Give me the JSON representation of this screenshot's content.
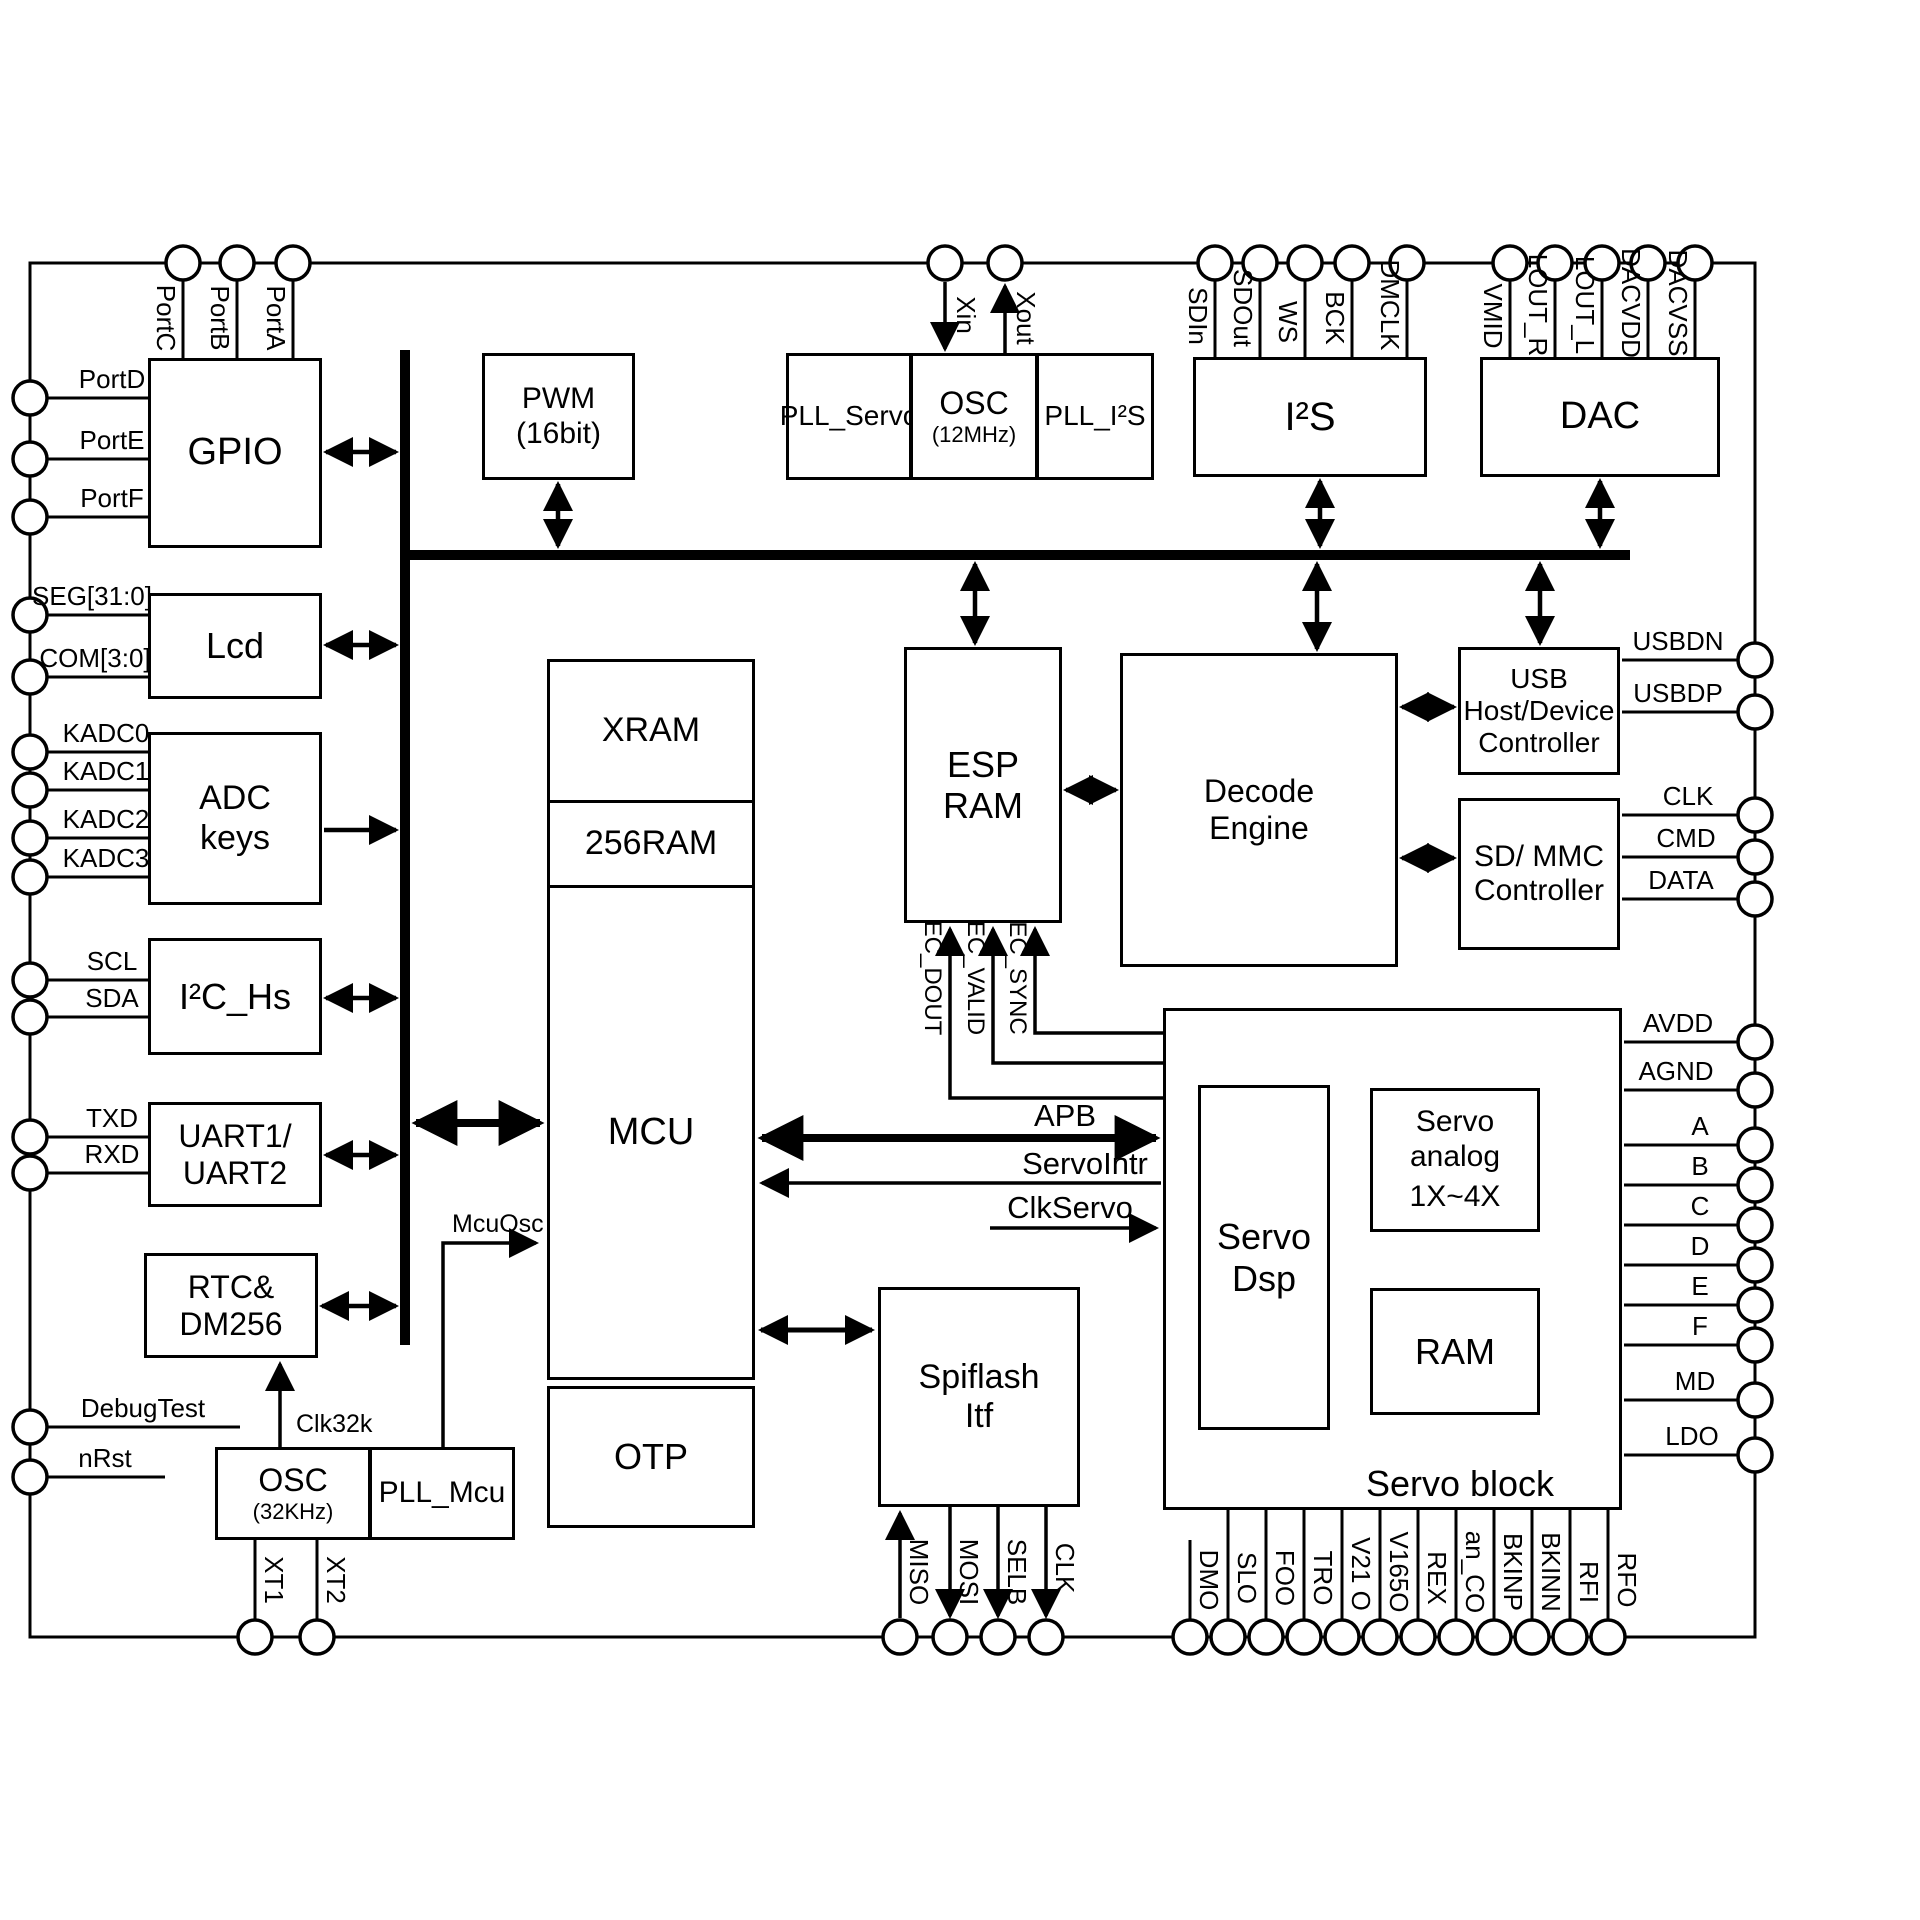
{
  "blocks": {
    "gpio": {
      "lines": [
        "GPIO"
      ]
    },
    "lcd": {
      "lines": [
        "Lcd"
      ]
    },
    "adc": {
      "lines": [
        "ADC",
        "keys"
      ]
    },
    "i2c": {
      "lines": [
        "I²C_Hs"
      ]
    },
    "uart": {
      "lines": [
        "UART1/",
        "UART2"
      ]
    },
    "rtc": {
      "lines": [
        "RTC&",
        "DM256"
      ]
    },
    "osc32": {
      "lines": [
        "OSC",
        "(32KHz)"
      ]
    },
    "pll_mcu": {
      "lines": [
        "PLL_Mcu"
      ]
    },
    "pwm": {
      "lines": [
        "PWM",
        "(16bit)"
      ]
    },
    "pll_servo": {
      "lines": [
        "PLL_Servo"
      ]
    },
    "osc12": {
      "lines": [
        "OSC",
        "(12MHz)"
      ]
    },
    "pll_i2s": {
      "lines": [
        "PLL_I²S"
      ]
    },
    "i2s": {
      "lines": [
        "I²S"
      ]
    },
    "dac": {
      "lines": [
        "DAC"
      ]
    },
    "xram": {
      "lines": [
        "XRAM"
      ]
    },
    "ram256": {
      "lines": [
        "256RAM"
      ]
    },
    "mcu": {
      "lines": [
        "MCU"
      ]
    },
    "otp": {
      "lines": [
        "OTP"
      ]
    },
    "esp_ram": {
      "lines": [
        "ESP RAM"
      ]
    },
    "decode": {
      "lines": [
        "Decode",
        "Engine"
      ]
    },
    "usb": {
      "lines": [
        "USB",
        "Host/Device",
        "Controller"
      ]
    },
    "sdmmc": {
      "lines": [
        "SD/ MMC",
        "Controller"
      ]
    },
    "spiflash": {
      "lines": [
        "Spiflash",
        "Itf"
      ]
    },
    "servo_dsp": {
      "lines": [
        "Servo Dsp"
      ]
    },
    "servo_analog": {
      "lines": [
        "Servo",
        "analog",
        "1X~4X"
      ]
    },
    "servo_ram": {
      "lines": [
        "RAM"
      ]
    },
    "servo_block": {
      "label": "Servo block"
    }
  },
  "pins": {
    "top": [
      {
        "label": "PortC"
      },
      {
        "label": "PortB"
      },
      {
        "label": "PortA"
      },
      {
        "label": "Xin"
      },
      {
        "label": "Xout"
      },
      {
        "label": "SDIn"
      },
      {
        "label": "SDOut"
      },
      {
        "label": "WS"
      },
      {
        "label": "BCK"
      },
      {
        "label": "DMCLK"
      },
      {
        "label": "VMID"
      },
      {
        "label": "LOUT_R"
      },
      {
        "label": "LOUT_L"
      },
      {
        "label": "DACVDD"
      },
      {
        "label": "DACVSS"
      }
    ],
    "left": [
      {
        "label": "PortD"
      },
      {
        "label": "PortE"
      },
      {
        "label": "PortF"
      },
      {
        "label": "SEG[31:0]"
      },
      {
        "label": "COM[3:0]"
      },
      {
        "label": "KADC0"
      },
      {
        "label": "KADC1"
      },
      {
        "label": "KADC2"
      },
      {
        "label": "KADC3"
      },
      {
        "label": "SCL"
      },
      {
        "label": "SDA"
      },
      {
        "label": "TXD"
      },
      {
        "label": "RXD"
      },
      {
        "label": "DebugTest"
      },
      {
        "label": "nRst"
      }
    ],
    "right": [
      {
        "label": "USBDN"
      },
      {
        "label": "USBDP"
      },
      {
        "label": "CLK"
      },
      {
        "label": "CMD"
      },
      {
        "label": "DATA"
      },
      {
        "label": "AVDD"
      },
      {
        "label": "AGND"
      },
      {
        "label": "A"
      },
      {
        "label": "B"
      },
      {
        "label": "C"
      },
      {
        "label": "D"
      },
      {
        "label": "E"
      },
      {
        "label": "F"
      },
      {
        "label": "MD"
      },
      {
        "label": "LDO"
      }
    ],
    "bottom": [
      {
        "label": "XT1"
      },
      {
        "label": "XT2"
      },
      {
        "label": "MISO"
      },
      {
        "label": "MOSI"
      },
      {
        "label": "SELB"
      },
      {
        "label": "CLK"
      },
      {
        "label": "DMO"
      },
      {
        "label": "SLO"
      },
      {
        "label": "FOO"
      },
      {
        "label": "TRO"
      },
      {
        "label": "V21 O"
      },
      {
        "label": "V165O"
      },
      {
        "label": "REX"
      },
      {
        "label": "an_CO"
      },
      {
        "label": "BKINP"
      },
      {
        "label": "BKINN"
      },
      {
        "label": "RFI"
      },
      {
        "label": "RFO"
      }
    ]
  },
  "signals": {
    "apb": "APB",
    "servo_intr": "ServoIntr",
    "clk_servo": "ClkServo",
    "clk32k": "Clk32k",
    "mcu_osc": "McuOsc",
    "ec_dout": "EC_DOUT",
    "ec_valid": "EC_VALID",
    "ec_sync": "EC_SYNC"
  }
}
